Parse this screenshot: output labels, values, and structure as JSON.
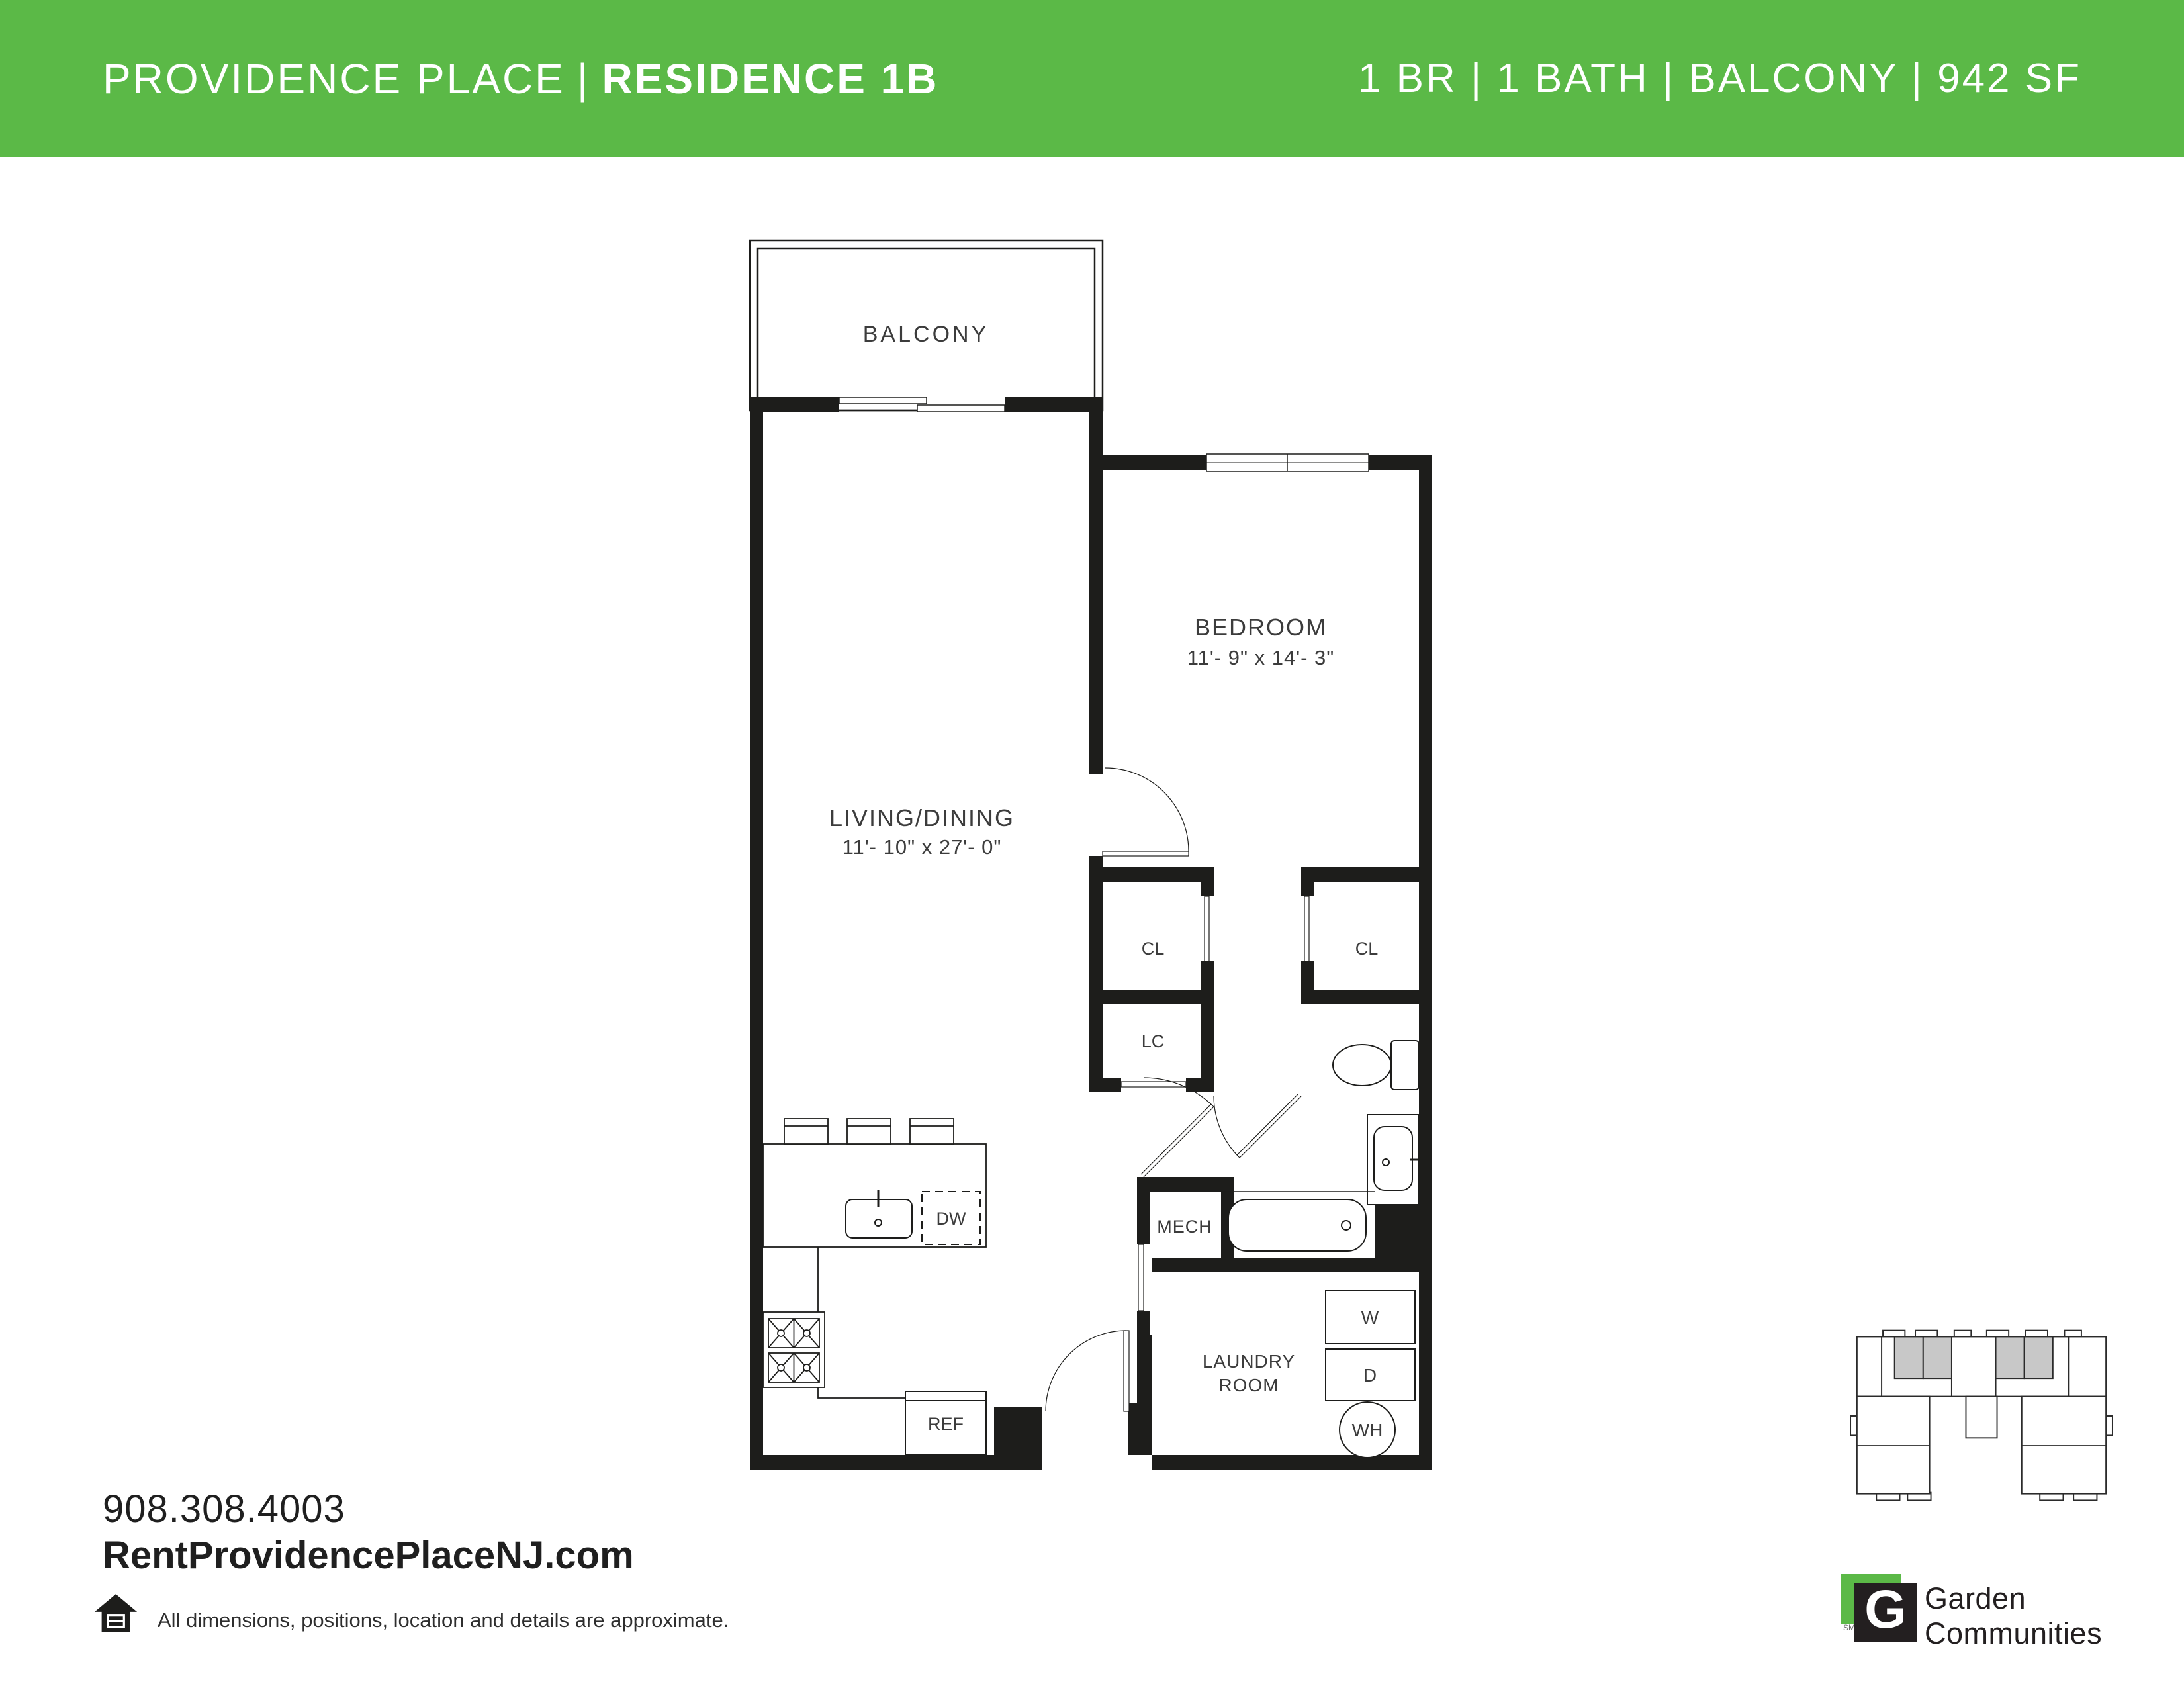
{
  "header": {
    "background": "#5BB947",
    "title_left": "PROVIDENCE PLACE",
    "separator": "|",
    "title_right": "RESIDENCE 1B",
    "specs": "1 BR | 1 BATH | BALCONY | 942 SF"
  },
  "floorplan": {
    "rooms": {
      "balcony": {
        "label": "BALCONY"
      },
      "living": {
        "label": "LIVING/DINING",
        "dims": "11'- 10\" x 27'- 0\""
      },
      "bedroom": {
        "label": "BEDROOM",
        "dims": "11'- 9\" x 14'- 3\""
      },
      "laundry": {
        "label_line1": "LAUNDRY",
        "label_line2": "ROOM"
      },
      "mech": {
        "label": "MECH"
      }
    },
    "closets": {
      "hall_closet": "CL",
      "bedroom_closet": "CL",
      "linen_closet": "LC"
    },
    "appliances": {
      "washer": "W",
      "dryer": "D",
      "water_heater": "WH",
      "dishwasher": "DW",
      "refrigerator": "REF"
    }
  },
  "contact": {
    "phone": "908.308.4003",
    "website": "RentProvidencePlaceNJ.com"
  },
  "disclaimer": "All dimensions, positions, location and details are approximate.",
  "logo": {
    "mark_letter": "G",
    "service_mark": "SM",
    "name_line1": "Garden",
    "name_line2": "Communities",
    "green": "#5BB947",
    "black": "#231F20"
  },
  "colors": {
    "wall": "#1d1d1b",
    "label": "#3c3c3c"
  }
}
